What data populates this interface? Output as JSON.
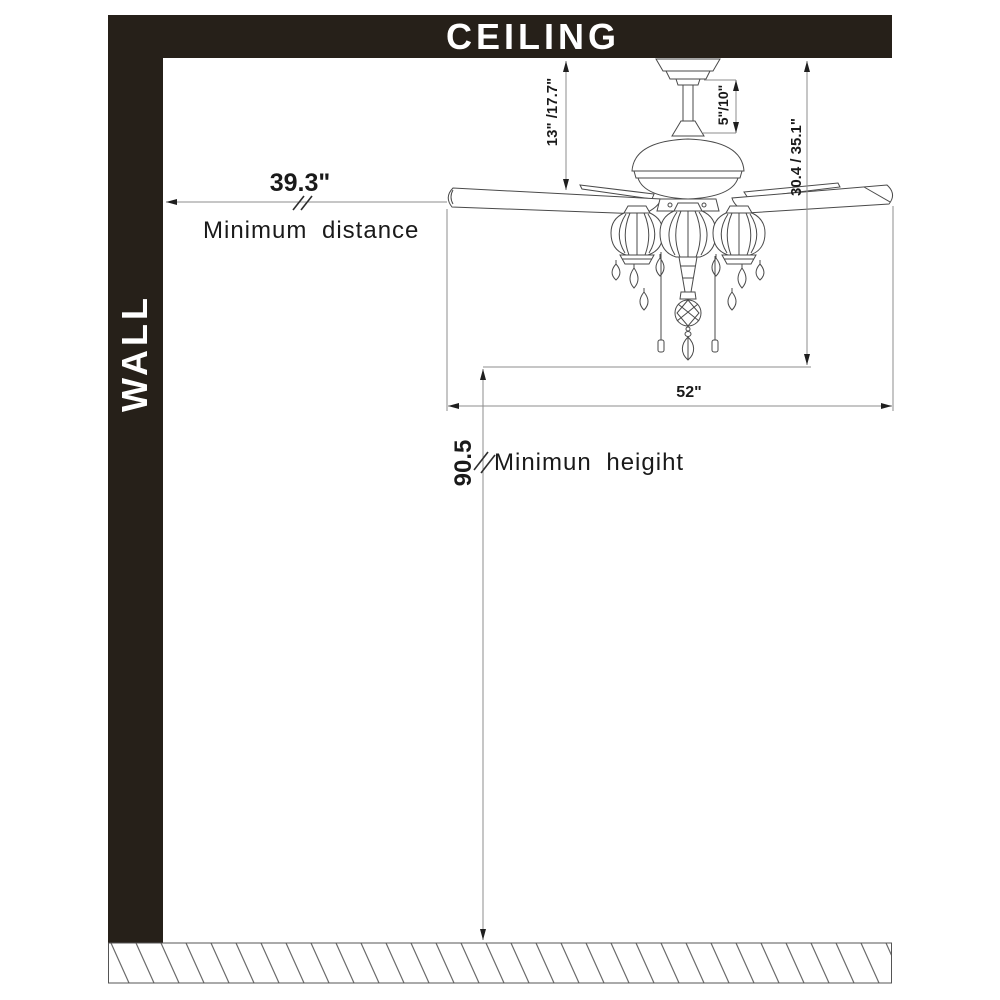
{
  "scene": {
    "ceiling_label": "CEILING",
    "wall_label": "WALL"
  },
  "dimensions": {
    "hanger_height": "13\" /17.7\"",
    "downrod_length": "5\"/10\"",
    "ceiling_to_bottom": "30.4 / 35.1\"",
    "min_wall_distance": {
      "value": "39.3\"",
      "caption": "Minimum distance"
    },
    "blade_span": "52\"",
    "min_floor_height": {
      "value": "90.5",
      "caption": "Minimun heigiht"
    }
  }
}
